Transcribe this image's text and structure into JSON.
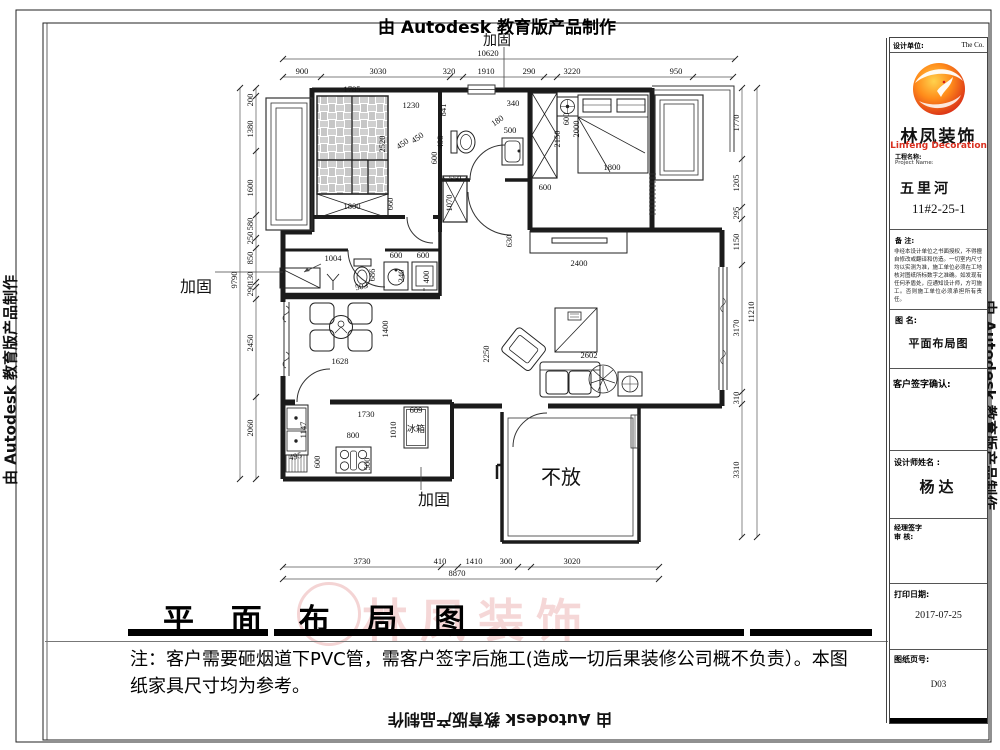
{
  "border": {
    "autodesk_text": "由 Autodesk 教育版产品制作"
  },
  "title_block": {
    "design_unit_label": "设计单位:",
    "design_unit_value": "The  Co.",
    "logo_name_cn": "林凤装饰",
    "logo_name_en": "Linfeng Decoration",
    "project_label_cn": "工程名称:",
    "project_label_en": "Project Name:",
    "project_name": "五里河",
    "project_number": "11#2-25-1",
    "remark_label": "备  注:",
    "remark_text": "非经本设计单位之书面授权，不得擅自修改或翻译和仿造。一切室内尺寸均以实测为准，施工单位必须在工地核对图纸所标数字之准确。如发现有任何矛盾处，应通知设计师，方可施工。否则施工单位必须承担所有责任。",
    "drawing_name_label": "图  名:",
    "drawing_name": "平面布局图",
    "client_sign_label": "客户签字确认:",
    "designer_label": "设计师姓名 :",
    "designer_name": "杨达",
    "manager_sign_label": "经理签字",
    "review_label": "审  核:",
    "print_date_label": "打印日期:",
    "print_date": "2017-07-25",
    "sheet_label": "图纸页号:",
    "sheet_number": "D03"
  },
  "footer": {
    "title": "平 面 布 局 图",
    "note_line1": "注：客户需要砸烟道下PVC管，需客户签字后施工(造成一切后果装修公司概不负责）。本图",
    "note_line2": "纸家具尺寸均为参考。"
  },
  "plan": {
    "room_labels": [
      {
        "text": "不放",
        "x": 561,
        "y": 484,
        "size": 20
      },
      {
        "text": "加固",
        "x": 497,
        "y": 45,
        "size": 14
      },
      {
        "text": "加固",
        "x": 196,
        "y": 292,
        "size": 16
      },
      {
        "text": "加固",
        "x": 434,
        "y": 505,
        "size": 16
      },
      {
        "text": "冰箱",
        "x": 416,
        "y": 432,
        "size": 9
      }
    ],
    "dim_chains": [
      {
        "dir": "h",
        "line": 59,
        "from": 283,
        "to": 735,
        "ticks": [
          283,
          735
        ],
        "labels": [
          {
            "t": "10620",
            "c": 488
          }
        ]
      },
      {
        "dir": "h",
        "line": 77,
        "from": 283,
        "to": 733,
        "ticks": [
          283,
          321,
          450,
          463,
          544,
          557,
          693,
          733
        ],
        "labels": [
          {
            "t": "900",
            "c": 302
          },
          {
            "t": "3030",
            "c": 378
          },
          {
            "t": "320",
            "c": 449
          },
          {
            "t": "1910",
            "c": 486
          },
          {
            "t": "290",
            "c": 529
          },
          {
            "t": "3220",
            "c": 572
          },
          {
            "t": "950",
            "c": 676
          }
        ]
      },
      {
        "dir": "v",
        "line": 256,
        "from": 88,
        "to": 479,
        "ticks": [
          88,
          96,
          151,
          215,
          238,
          248,
          282,
          287,
          299,
          397,
          479
        ],
        "labels": [
          {
            "t": "200",
            "c": 100
          },
          {
            "t": "1380",
            "c": 129
          },
          {
            "t": "1600",
            "c": 188
          },
          {
            "t": "580",
            "c": 224
          },
          {
            "t": "250",
            "c": 238
          },
          {
            "t": "850",
            "c": 258
          },
          {
            "t": "130",
            "c": 278
          },
          {
            "t": "290",
            "c": 290
          },
          {
            "t": "2450",
            "c": 343
          },
          {
            "t": "2060",
            "c": 428
          }
        ]
      },
      {
        "dir": "v",
        "line": 240,
        "from": 88,
        "to": 479,
        "ticks": [
          88,
          479
        ],
        "labels": [
          {
            "t": "9790",
            "c": 280
          }
        ]
      },
      {
        "dir": "v",
        "line": 742,
        "from": 88,
        "to": 537,
        "ticks": [
          88,
          159,
          207,
          219,
          265,
          392,
          404,
          537
        ],
        "labels": [
          {
            "t": "1770",
            "c": 123
          },
          {
            "t": "1205",
            "c": 183
          },
          {
            "t": "295",
            "c": 213
          },
          {
            "t": "1150",
            "c": 242
          },
          {
            "t": "3170",
            "c": 328
          },
          {
            "t": "310",
            "c": 398
          },
          {
            "t": "3310",
            "c": 470
          }
        ]
      },
      {
        "dir": "v",
        "line": 757,
        "from": 88,
        "to": 537,
        "ticks": [
          88,
          537
        ],
        "labels": [
          {
            "t": "11210",
            "c": 312
          }
        ]
      },
      {
        "dir": "h",
        "line": 567,
        "from": 283,
        "to": 659,
        "ticks": [
          283,
          441,
          458,
          518,
          531,
          659
        ],
        "labels": [
          {
            "t": "3730",
            "c": 362
          },
          {
            "t": "410",
            "c": 440
          },
          {
            "t": "1410",
            "c": 474
          },
          {
            "t": "300",
            "c": 506
          },
          {
            "t": "3020",
            "c": 572
          }
        ]
      },
      {
        "dir": "h",
        "line": 579,
        "from": 283,
        "to": 659,
        "ticks": [
          283,
          659
        ],
        "labels": [
          {
            "t": "8870",
            "c": 457
          }
        ]
      }
    ],
    "interior_dims": [
      {
        "t": "1785",
        "x": 352,
        "y": 92,
        "r": 0
      },
      {
        "t": "1230",
        "x": 411,
        "y": 108,
        "r": 0
      },
      {
        "t": "450",
        "x": 404,
        "y": 146,
        "r": -35
      },
      {
        "t": "450",
        "x": 419,
        "y": 140,
        "r": -35
      },
      {
        "t": "2520",
        "x": 385,
        "y": 144,
        "r": -90
      },
      {
        "t": "1800",
        "x": 352,
        "y": 209,
        "r": 0
      },
      {
        "t": "660",
        "x": 393,
        "y": 204,
        "r": -90
      },
      {
        "t": "841",
        "x": 446,
        "y": 110,
        "r": -90
      },
      {
        "t": "498",
        "x": 443,
        "y": 142,
        "r": -90
      },
      {
        "t": "600",
        "x": 437,
        "y": 158,
        "r": -90
      },
      {
        "t": "340",
        "x": 513,
        "y": 106,
        "r": 0
      },
      {
        "t": "180",
        "x": 499,
        "y": 123,
        "r": -35
      },
      {
        "t": "500",
        "x": 510,
        "y": 133,
        "r": 0
      },
      {
        "t": "550",
        "x": 455,
        "y": 181,
        "r": 0
      },
      {
        "t": "1070",
        "x": 452,
        "y": 203,
        "r": -90
      },
      {
        "t": "2150",
        "x": 560,
        "y": 139,
        "r": -90
      },
      {
        "t": "600",
        "x": 545,
        "y": 190,
        "r": 0
      },
      {
        "t": "600",
        "x": 569,
        "y": 119,
        "r": -90
      },
      {
        "t": "2000",
        "x": 579,
        "y": 129,
        "r": -90
      },
      {
        "t": "1800",
        "x": 612,
        "y": 170,
        "r": 0
      },
      {
        "t": "630",
        "x": 512,
        "y": 241,
        "r": -90
      },
      {
        "t": "2400",
        "x": 579,
        "y": 266,
        "r": 0
      },
      {
        "t": "2250",
        "x": 489,
        "y": 354,
        "r": -90
      },
      {
        "t": "2602",
        "x": 589,
        "y": 358,
        "r": 0
      },
      {
        "t": "1004",
        "x": 333,
        "y": 261,
        "r": 0
      },
      {
        "t": "503",
        "x": 362,
        "y": 289,
        "r": -12
      },
      {
        "t": "686",
        "x": 375,
        "y": 275,
        "r": -90
      },
      {
        "t": "600",
        "x": 396,
        "y": 258,
        "r": 0
      },
      {
        "t": "600",
        "x": 423,
        "y": 258,
        "r": 0
      },
      {
        "t": "340",
        "x": 404,
        "y": 276,
        "r": -90
      },
      {
        "t": "400",
        "x": 429,
        "y": 277,
        "r": -90
      },
      {
        "t": "1628",
        "x": 340,
        "y": 364,
        "r": 0
      },
      {
        "t": "1400",
        "x": 388,
        "y": 329,
        "r": -90
      },
      {
        "t": "1730",
        "x": 366,
        "y": 417,
        "r": 0
      },
      {
        "t": "800",
        "x": 353,
        "y": 438,
        "r": 0
      },
      {
        "t": "1010",
        "x": 396,
        "y": 430,
        "r": -90
      },
      {
        "t": "609",
        "x": 416,
        "y": 413,
        "r": 0
      },
      {
        "t": "1147",
        "x": 306,
        "y": 430,
        "r": -90
      },
      {
        "t": "495",
        "x": 296,
        "y": 459,
        "r": -12
      },
      {
        "t": "600",
        "x": 320,
        "y": 462,
        "r": -90
      },
      {
        "t": "500",
        "x": 370,
        "y": 464,
        "r": -90
      }
    ]
  }
}
